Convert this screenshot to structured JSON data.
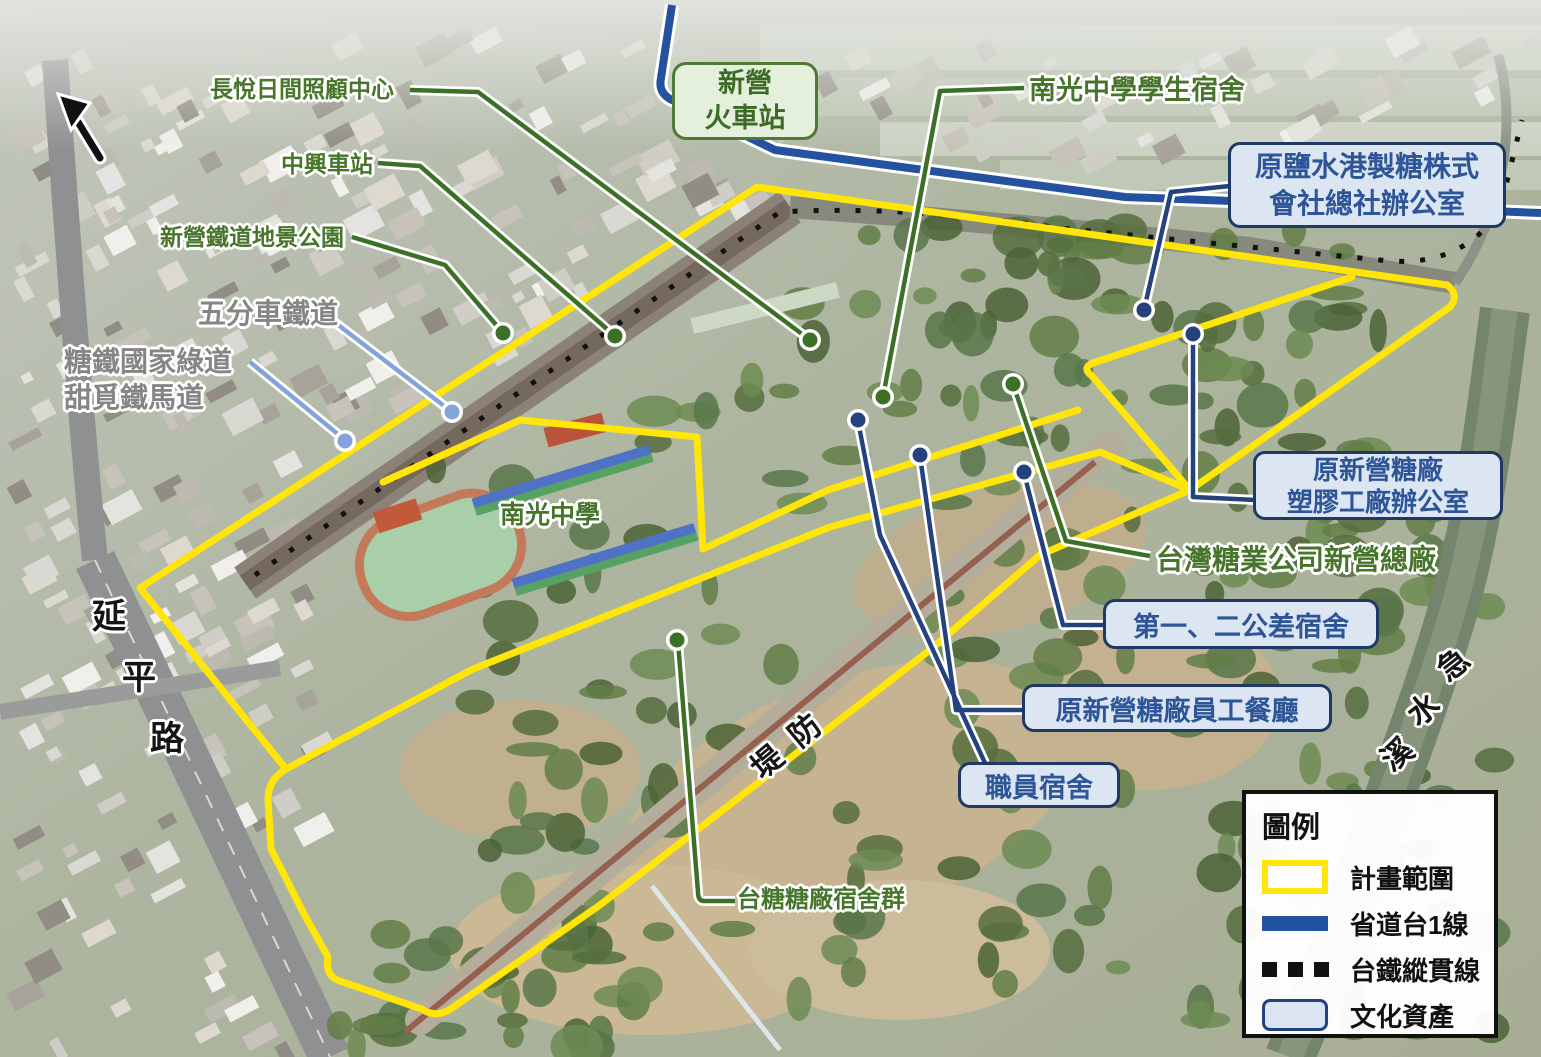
{
  "annotations": {
    "green_labels": [
      {
        "id": "changyue",
        "text": "長悅日間照顧中心"
      },
      {
        "id": "zhongxing",
        "text": "中興車站"
      },
      {
        "id": "dijing_park",
        "text": "新營鐵道地景公園"
      },
      {
        "id": "nanguang_dorm",
        "text": "南光中學學生宿舍"
      },
      {
        "id": "taisugar_hq",
        "text": "台灣糖業公司新營總廠"
      },
      {
        "id": "dorm_cluster",
        "text": "台糖糖廠宿舍群"
      },
      {
        "id": "nanguang_school",
        "text": "南光中學"
      }
    ],
    "gray_labels": [
      {
        "id": "wufenche",
        "text": "五分車鐵道"
      },
      {
        "id": "greenway",
        "line1": "糖鐵國家綠道",
        "line2": "甜覓鐵馬道"
      }
    ],
    "station_box": {
      "line1": "新營",
      "line2": "火車站"
    },
    "blue_boxes": [
      {
        "id": "yanshuigang",
        "line1": "原鹽水港製糖株式",
        "line2": "會社總社辦公室"
      },
      {
        "id": "plastic",
        "line1": "原新營糖廠",
        "line2": "塑膠工廠辦公室"
      },
      {
        "id": "gongcha",
        "line1": "第一、二公差宿舍"
      },
      {
        "id": "canteen",
        "line1": "原新營糖廠員工餐廳"
      },
      {
        "id": "staff_dorm",
        "line1": "職員宿舍"
      }
    ],
    "photo_labels": {
      "yanping_road": {
        "chars": [
          "延",
          "平",
          "路"
        ]
      },
      "dike": {
        "text": "堤防"
      },
      "jishui_river": {
        "chars": [
          "急",
          "水",
          "溪"
        ]
      }
    }
  },
  "legend": {
    "title": "圖例",
    "items": [
      {
        "label": "計畫範圍",
        "swatch": "plan-boundary"
      },
      {
        "label": "省道台1線",
        "swatch": "provincial-route"
      },
      {
        "label": "台鐵縱貫線",
        "swatch": "railway-trunk"
      },
      {
        "label": "文化資產",
        "swatch": "cultural-asset"
      }
    ]
  },
  "colors": {
    "plan_boundary": "#ffe608",
    "provincial_route": "#24529e",
    "railway": "#111111",
    "cultural_asset_fill": "#dce6f3",
    "cultural_asset_border": "#1f3864",
    "green_annotation": "#47752c",
    "gray_annotation": "#858585",
    "light_blue_leader": "#84a3d8"
  }
}
